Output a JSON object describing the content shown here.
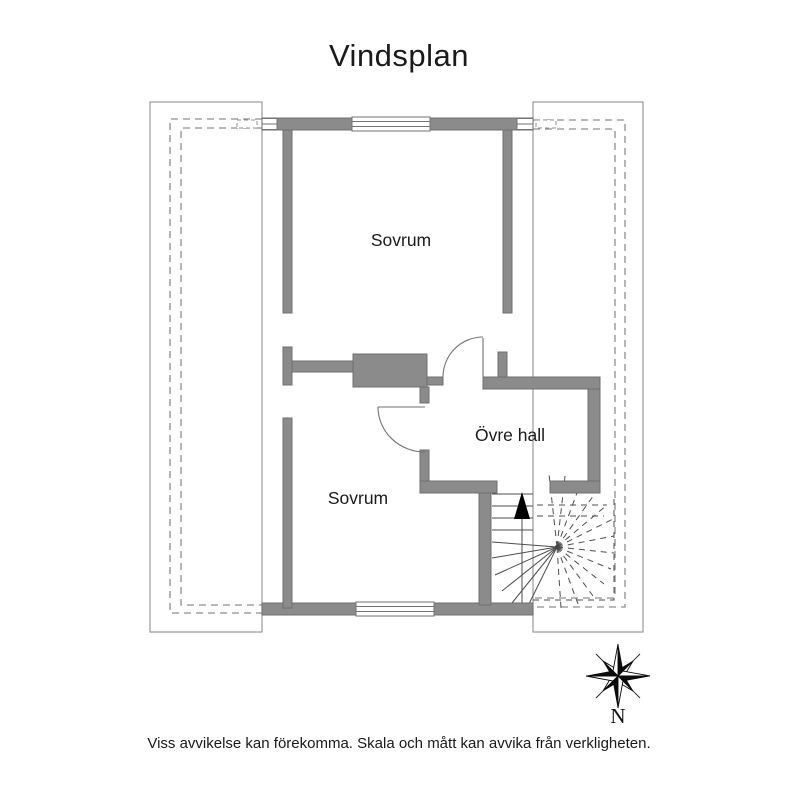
{
  "title": "Vindsplan",
  "plan": {
    "rooms": [
      {
        "id": "bedroom-top",
        "label": "Sovrum"
      },
      {
        "id": "bedroom-bottom",
        "label": "Sovrum"
      },
      {
        "id": "upper-hall",
        "label": "Övre hall"
      }
    ]
  },
  "compass": {
    "north_label": "N"
  },
  "disclaimer": "Viss avvikelse kan förekomma. Skala och mått kan avvika från verkligheten.",
  "colors": {
    "wall_fill": "#8b8b8b",
    "wall_stroke": "#6f6f6f",
    "outline": "#9a9a9a",
    "dashed": "#8f8f8f",
    "stair": "#4d4d4d",
    "door": "#737373",
    "text": "#1a1a1a"
  }
}
